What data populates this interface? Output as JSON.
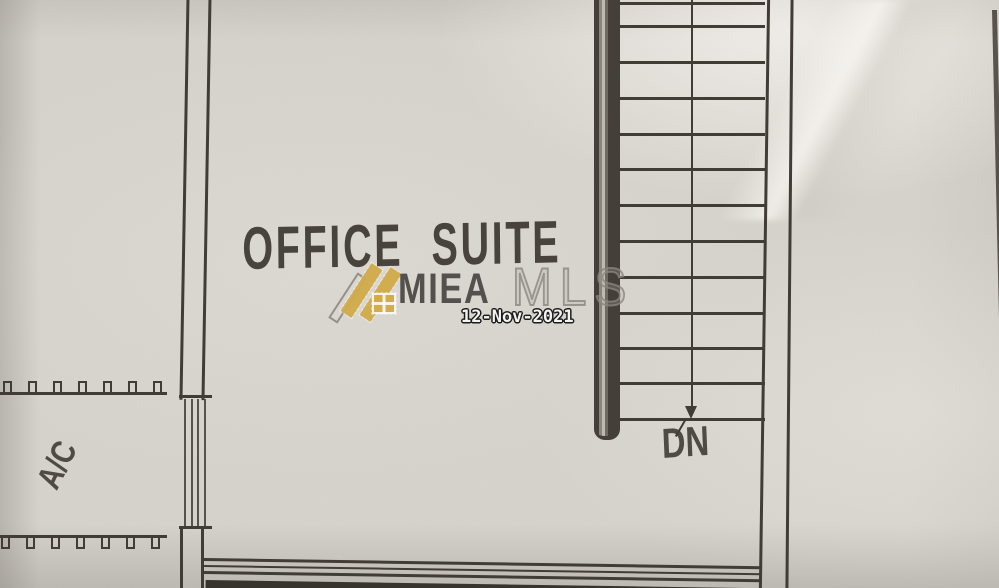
{
  "plan": {
    "room_label": "OFFICE SUITE",
    "stair_direction_label": "DN",
    "ac_label": "A/C"
  },
  "watermark": {
    "brand_primary": "MIEA",
    "brand_secondary": "MLS",
    "date": "12-Nov-2021"
  },
  "palette": {
    "paper": "#d6d3cc",
    "ink": "#413c35",
    "gold": "#d2ab4a",
    "wall_fill": "#443f38",
    "date_text": "#f4f3f0"
  }
}
